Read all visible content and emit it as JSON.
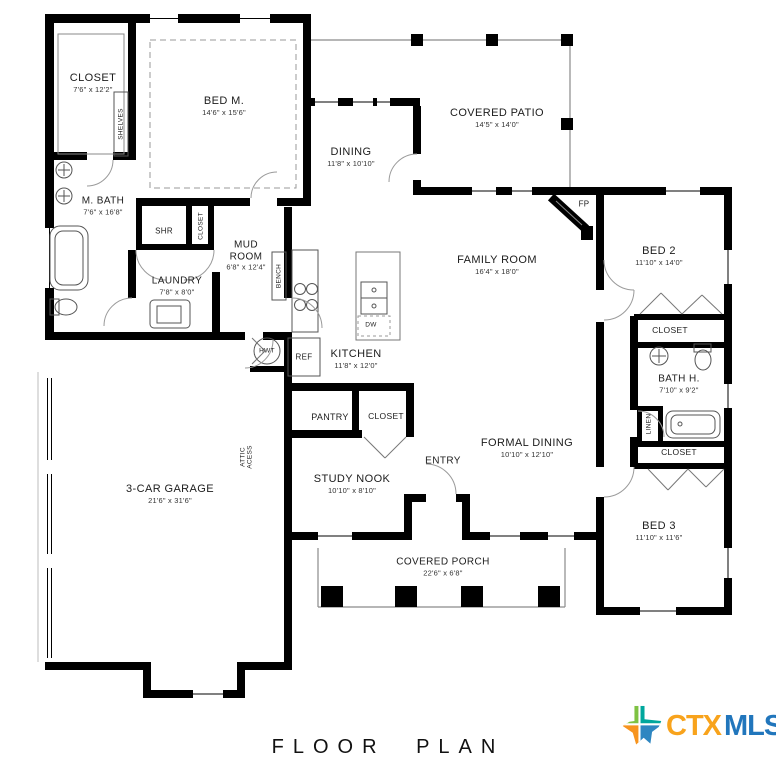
{
  "title": "FLOOR PLAN",
  "logo": {
    "prefix": "CTX",
    "suffix": "MLS"
  },
  "rooms": {
    "master_closet": {
      "name": "CLOSET",
      "dims": "7'6\" x 12'2\""
    },
    "bed_m": {
      "name": "BED M.",
      "dims": "14'6\" x 15'6\""
    },
    "m_bath": {
      "name": "M. BATH",
      "dims": "7'6\" x 16'8\""
    },
    "mud_room": {
      "line1": "MUD",
      "line2": "ROOM",
      "dims": "6'8\" x 12'4\""
    },
    "laundry": {
      "name": "LAUNDRY",
      "dims": "7'8\" x 8'0\""
    },
    "dining": {
      "name": "DINING",
      "dims": "11'8\" x 10'10\""
    },
    "covered_patio": {
      "name": "COVERED PATIO",
      "dims": "14'5\" x 14'0\""
    },
    "family_room": {
      "name": "FAMILY ROOM",
      "dims": "16'4\" x 18'0\""
    },
    "kitchen": {
      "name": "KITCHEN",
      "dims": "11'8\" x 12'0\""
    },
    "bed_2": {
      "name": "BED 2",
      "dims": "11'10\" x 14'0\""
    },
    "bath_h": {
      "name": "BATH H.",
      "dims": "7'10\" x 9'2\""
    },
    "formal_dining": {
      "name": "FORMAL DINING",
      "dims": "10'10\" x 12'10\""
    },
    "study_nook": {
      "name": "STUDY NOOK",
      "dims": "10'10\" x 8'10\""
    },
    "bed_3": {
      "name": "BED 3",
      "dims": "11'10\" x 11'6\""
    },
    "garage": {
      "name": "3-CAR GARAGE",
      "dims": "21'6\" x 31'6\""
    },
    "covered_porch": {
      "name": "COVERED PORCH",
      "dims": "22'6\" x 6'8\""
    },
    "entry": {
      "name": "ENTRY"
    }
  },
  "labels": {
    "shelves": "SHELVES",
    "shr": "SHR",
    "closet_master_hall": "CLOSET",
    "bench": "BENCH",
    "hwt": "HWT",
    "ref": "REF",
    "dw": "DW",
    "fp": "FP",
    "pantry": "PANTRY",
    "closet_nook": "CLOSET",
    "attic_line1": "ATTIC",
    "attic_line2": "ACESS",
    "closet_bed2": "CLOSET",
    "linen": "LINEN",
    "closet_bed3": "CLOSET"
  },
  "colors": {
    "wall": "#000000",
    "logo_ctx": "#F8A31C",
    "logo_mls": "#2176BC",
    "texas_green": "#7EC242",
    "texas_teal": "#00A79D",
    "texas_orange": "#F7941E",
    "texas_blue": "#2E86C1"
  }
}
